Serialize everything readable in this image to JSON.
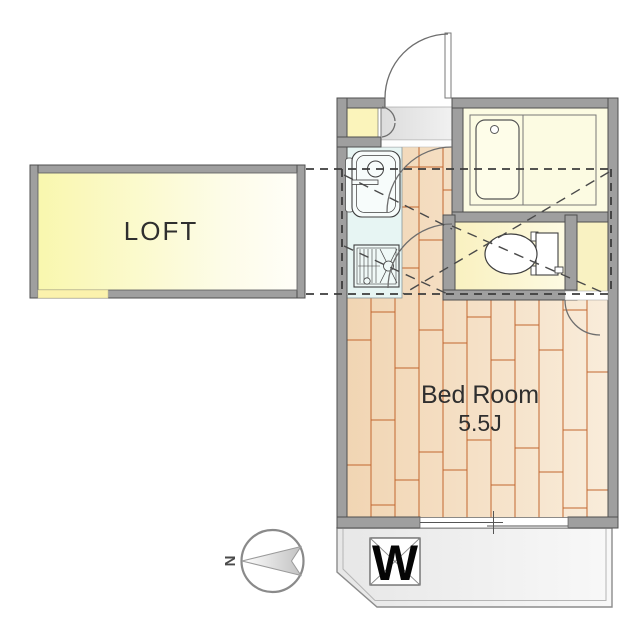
{
  "floor_plan": {
    "loft": {
      "label": "LOFT"
    },
    "bedroom": {
      "name": "Bed Room",
      "size": "5.5J"
    },
    "balcony": {
      "washing_machine": "W"
    },
    "compass": {
      "north": "N"
    },
    "colors": {
      "wall": "#9f9f9f",
      "wood_floor": "#f1d5b3",
      "wood_line": "#c2672f",
      "kitchen_floor": "#e7f5f3",
      "wet_area_yellow": "#fcfbe2",
      "loft_fill": "#f9f7ae",
      "balcony_gray": "#e7e7e7"
    }
  }
}
